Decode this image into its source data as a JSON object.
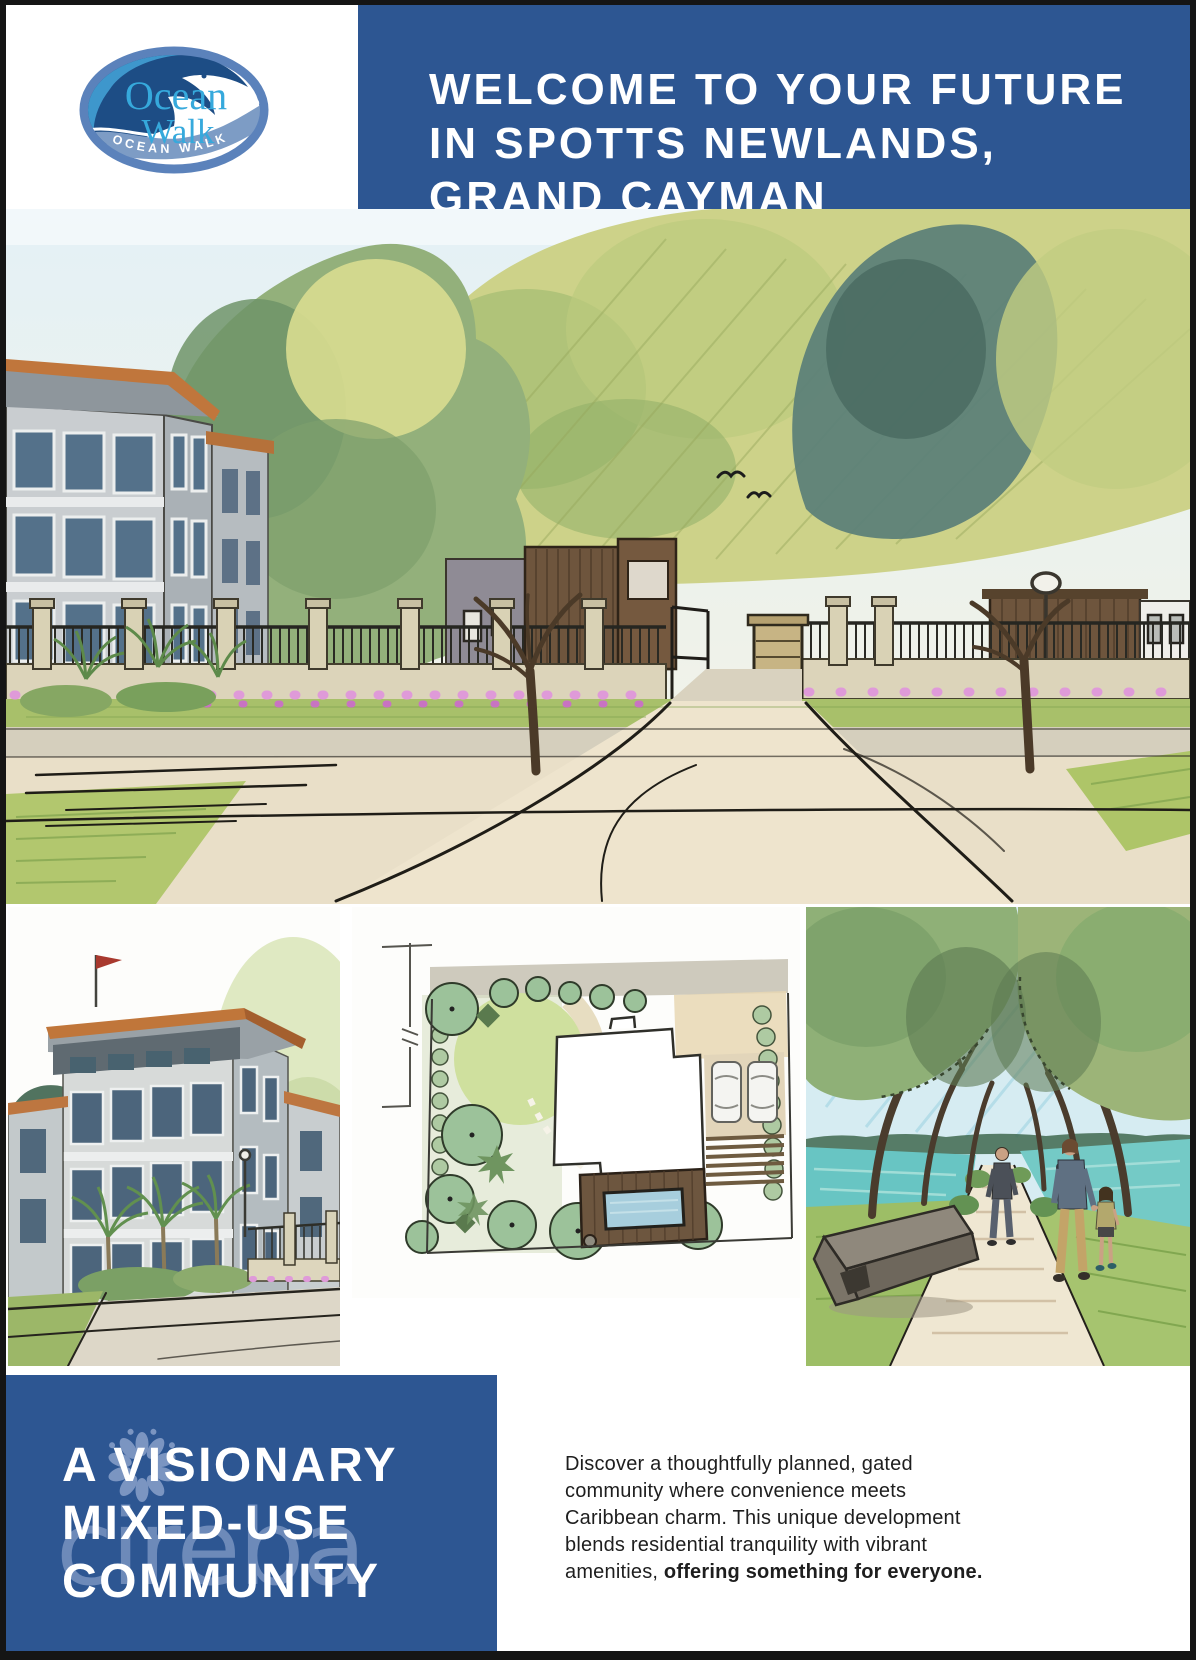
{
  "colors": {
    "primary_blue": "#2d5692",
    "text_dark": "#1e1e1e",
    "watermark_blue": "#a3b5da",
    "logo_light_blue": "#36a9dc",
    "logo_dark_blue": "#1d4d85",
    "logo_ring_blue": "#5b82bb",
    "logo_band_blue": "#7d9cc5",
    "flower_pink": "#df9ad9"
  },
  "logo": {
    "word_top": "Ocean",
    "word_bottom": "Walk",
    "ribbon": "OCEAN WALK"
  },
  "header": {
    "title_lines": [
      "WELCOME TO YOUR FUTURE",
      "IN SPOTTS NEWLANDS,",
      "GRAND CAYMAN"
    ],
    "subtitle": "Now Preselling Residential Lots –",
    "subtitle_bold": "Starting at Just $160K!"
  },
  "community": {
    "heading_lines": [
      "A VISIONARY",
      "MIXED-USE",
      "COMMUNITY"
    ],
    "watermark": "cireba"
  },
  "description": {
    "lines": [
      "Discover a thoughtfully planned, gated",
      "community where convenience meets",
      "Caribbean charm. This unique development",
      "blends residential tranquility with vibrant"
    ],
    "last_regular": "amenities, ",
    "last_bold": "offering something for everyone."
  }
}
